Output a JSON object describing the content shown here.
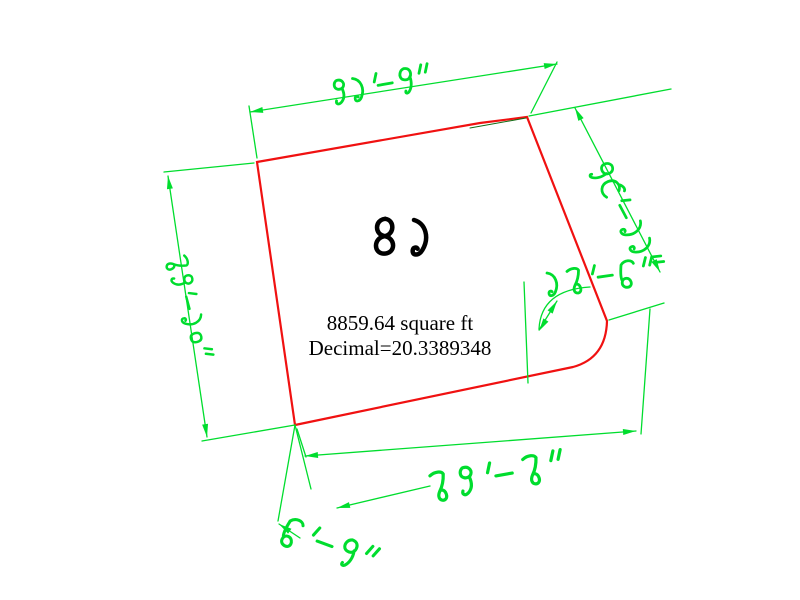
{
  "drawing": {
    "plot_number": "৪১",
    "area_text": "8859.64 square ft",
    "decimal_text": "Decimal=20.3389348",
    "dimensions": {
      "top": "৯১'-৭\"",
      "left": "৮৯'-১০\"",
      "right_upper": "৭৩'-১১\"",
      "right_notch": "১৮'-৬\"",
      "bottom": "৮৯'-৮\"",
      "spur": "৬'-৭\""
    },
    "colors": {
      "boundary": "#f01111",
      "dimension": "#00dd2e",
      "text": "#000000",
      "background": "#ffffff"
    }
  }
}
